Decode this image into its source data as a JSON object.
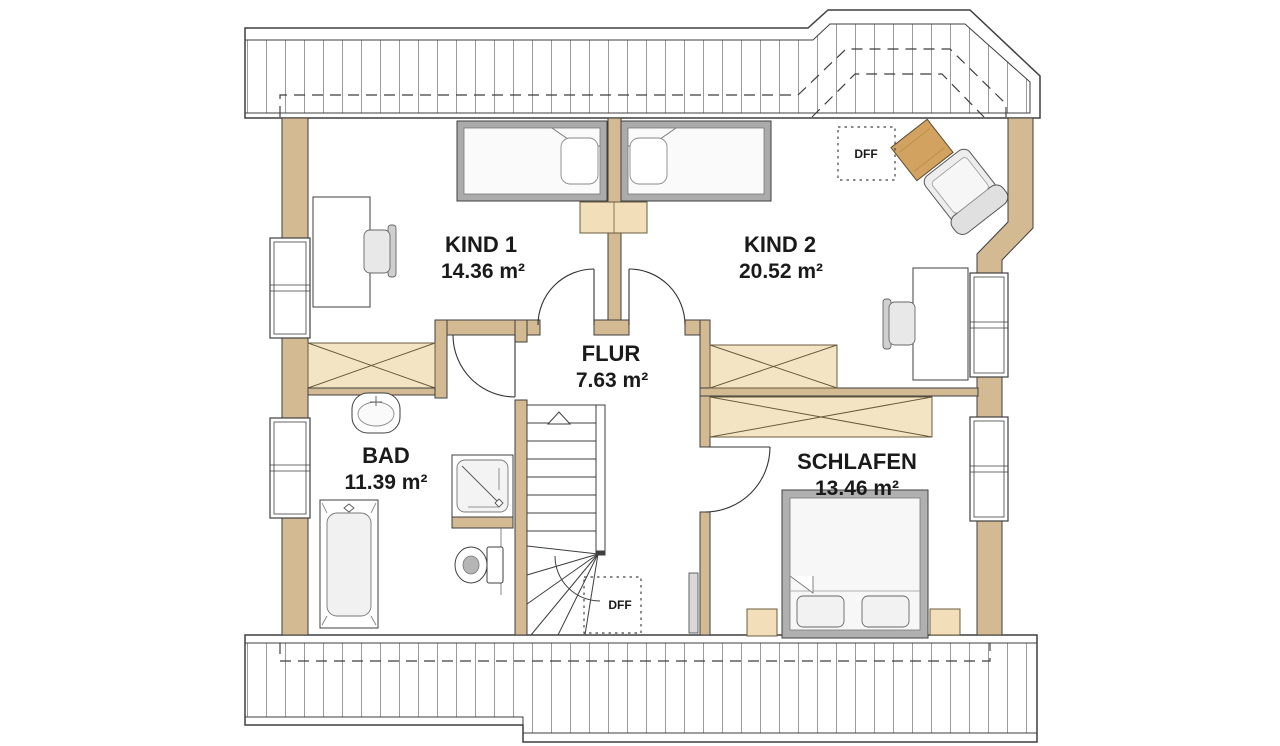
{
  "plan": {
    "rooms": [
      {
        "id": "kind1",
        "name": "KIND 1",
        "area": "14.36 m²"
      },
      {
        "id": "kind2",
        "name": "KIND 2",
        "area": "20.52 m²"
      },
      {
        "id": "flur",
        "name": "FLUR",
        "area": "7.63 m²"
      },
      {
        "id": "bad",
        "name": "BAD",
        "area": "11.39 m²"
      },
      {
        "id": "schlafen",
        "name": "SCHLAFEN",
        "area": "13.46 m²"
      }
    ],
    "roof_windows": [
      {
        "label": "DFF"
      },
      {
        "label": "DFF"
      }
    ],
    "colors": {
      "wall": "#d3ba92",
      "wardrobe_wood": "#f3e5c3",
      "furniture_wood": "#f2dfba",
      "desk_wood": "#d2a360",
      "bed_frame_gray": "#ababab",
      "outline": "#3f3f3f",
      "hatch": "#9a9a9a",
      "text": "#1a1a1a",
      "background": "#ffffff"
    }
  }
}
